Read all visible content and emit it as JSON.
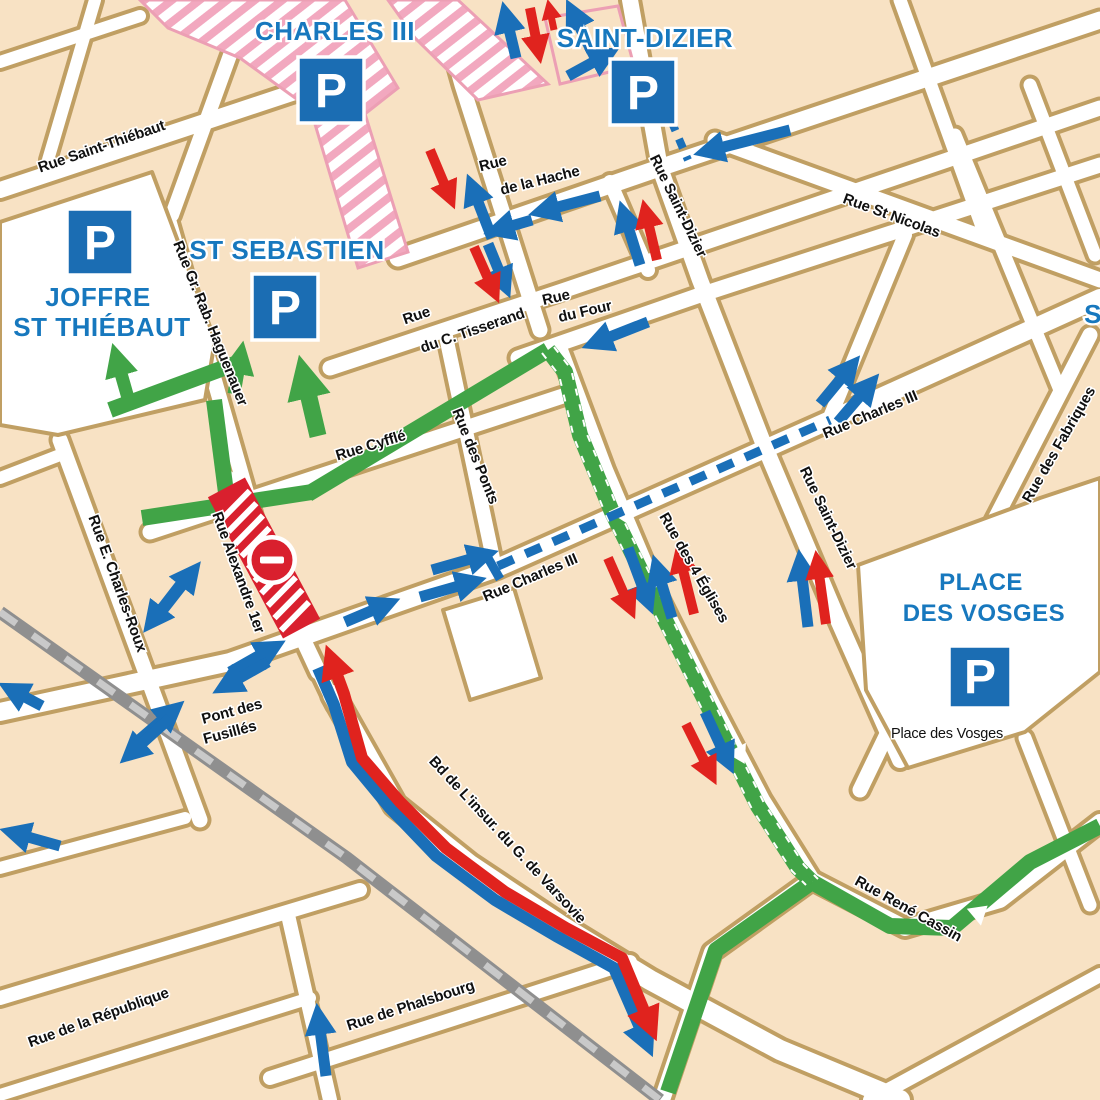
{
  "map_title": "city deviation and parking map",
  "colors": {
    "building": "#f8e2c4",
    "building_border": "#c09f63",
    "street_white": "#ffffff",
    "route_green": "#41a447",
    "arrow_blue": "#1a6fb8",
    "arrow_red": "#e0231e",
    "district_blue": "#1778be",
    "parking_blue": "#1b6db3",
    "closure_red": "#d9202e",
    "construction_pink": "#f2a8bf",
    "railway_gray": "#8f8f8f"
  },
  "icons": {
    "parking": "parking-icon",
    "no_entry": "no-entry-icon",
    "route_direction_triangle": "route-direction-icon"
  },
  "parking": {
    "letter": "P"
  },
  "districts": {
    "charles_iii": "CHARLES III",
    "saint_dizier": "SAINT-DIZIER",
    "st_sebastien": "ST SEBASTIEN",
    "joffre": "JOFFRE",
    "st_thiebaut": "ST THIÉBAUT",
    "place": "PLACE",
    "des_vosges": "DES VOSGES",
    "edge_partial": "S"
  },
  "streets": {
    "saint_thiebaut": "Rue Saint-Thiébaut",
    "hache_1": "Rue",
    "hache_2": "de la Hache",
    "saint_dizier_top": "Rue Saint-Dizier",
    "st_nicolas": "Rue St Nicolas",
    "haguenauer": "Rue Gr. Rab. Haguenauer",
    "tisserand_1": "Rue",
    "tisserand_2": "du C. Tisserand",
    "four_1": "Rue",
    "four_2": "du Four",
    "cyffle": "Rue Cyfflé",
    "ponts": "Rue des Ponts",
    "charles_iii_east": "Rue Charles III",
    "saint_dizier_right": "Rue Saint-Dizier",
    "fabriques": "Rue des Fabriques",
    "charles_iii_center": "Rue Charles III",
    "quatre_eglises": "Rue des 4 Églises",
    "charles_roux": "Rue E. Charles-Roux",
    "alexandre": "Rue Alexandre 1er",
    "pont_fusilles_1": "Pont des",
    "pont_fusilles_2": "Fusillés",
    "varsovie": "Bd de L'insur. du G. de Varsovie",
    "phalsbourg": "Rue de Phalsbourg",
    "republique": "Rue de la République",
    "rene_cassin": "Rue René Cassin",
    "place_des_vosges_small": "Place des Vosges"
  }
}
